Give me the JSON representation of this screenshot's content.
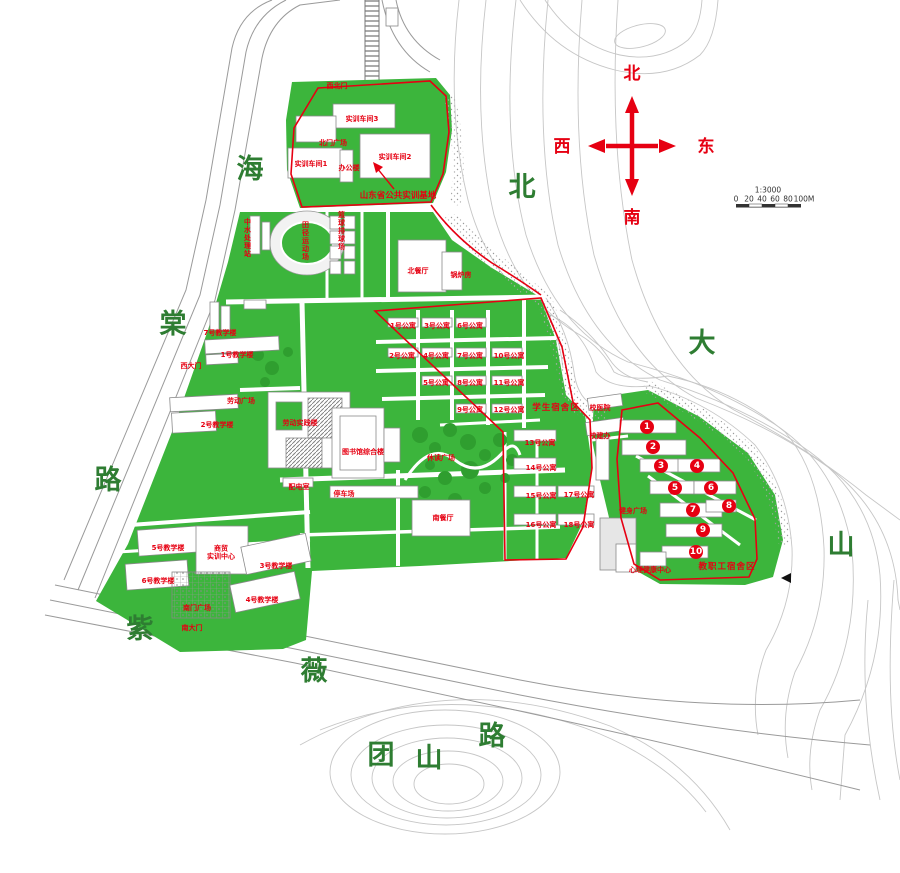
{
  "colors": {
    "campus_green": "#3cb53c",
    "label_red": "#e60012",
    "road_name_green": "#2e7d32",
    "contour_gray": "#c6c6c6"
  },
  "compass": {
    "north": "北",
    "south": "南",
    "east": "东",
    "west": "西"
  },
  "scale": {
    "ratio": "1:3000",
    "ticks": [
      "0",
      "20",
      "40",
      "60",
      "80",
      "100M"
    ]
  },
  "road_names": [
    {
      "name": "road-haitang-char-1",
      "text": "海",
      "x": 250,
      "y": 170
    },
    {
      "name": "road-haitang-char-2",
      "text": "棠",
      "x": 173,
      "y": 325
    },
    {
      "name": "road-haitang-char-3",
      "text": "路",
      "x": 108,
      "y": 481
    },
    {
      "name": "road-ziwei-char-1",
      "text": "紫",
      "x": 140,
      "y": 630
    },
    {
      "name": "road-ziwei-char-2",
      "text": "薇",
      "x": 314,
      "y": 672
    },
    {
      "name": "road-tuanshan-char-3",
      "text": "路",
      "x": 492,
      "y": 737
    },
    {
      "name": "road-tuanshan-char-1",
      "text": "团",
      "x": 381,
      "y": 756
    },
    {
      "name": "road-tuanshan-char-2",
      "text": "山",
      "x": 429,
      "y": 759
    },
    {
      "name": "mountain-beidashan-char-1",
      "text": "北",
      "x": 522,
      "y": 188
    },
    {
      "name": "mountain-beidashan-char-2",
      "text": "大",
      "x": 702,
      "y": 344
    },
    {
      "name": "mountain-beidashan-char-3",
      "text": "山",
      "x": 841,
      "y": 546
    }
  ],
  "labels": [
    {
      "name": "gate-northwest",
      "text": "西北门",
      "x": 337,
      "y": 86
    },
    {
      "name": "training-workshop-3",
      "text": "实训车间3",
      "x": 362,
      "y": 119
    },
    {
      "name": "north-gate-plaza",
      "text": "北门广场",
      "x": 333,
      "y": 143
    },
    {
      "name": "training-workshop-1",
      "text": "实训车间1",
      "x": 311,
      "y": 164
    },
    {
      "name": "office-building",
      "text": "办公楼",
      "x": 349,
      "y": 168
    },
    {
      "name": "training-workshop-2",
      "text": "实训车间2",
      "x": 395,
      "y": 157
    },
    {
      "name": "training-base-annotation",
      "text": "山东省公共实训基地",
      "x": 398,
      "y": 196,
      "cls": "note"
    },
    {
      "name": "water-treatment-station",
      "text": "中水处理站",
      "x": 247,
      "y": 238,
      "cls": "vert"
    },
    {
      "name": "athletics-field",
      "text": "田径运动场",
      "x": 305,
      "y": 241,
      "cls": "vert"
    },
    {
      "name": "basketball-volleyball-courts",
      "text": "篮球排球场",
      "x": 341,
      "y": 231,
      "cls": "vert"
    },
    {
      "name": "north-dining-hall",
      "text": "北餐厅",
      "x": 418,
      "y": 271
    },
    {
      "name": "boiler-room",
      "text": "锅炉房",
      "x": 461,
      "y": 275
    },
    {
      "name": "apartment-1",
      "text": "1号公寓",
      "x": 403,
      "y": 326
    },
    {
      "name": "apartment-3",
      "text": "3号公寓",
      "x": 437,
      "y": 326
    },
    {
      "name": "apartment-6",
      "text": "6号公寓",
      "x": 470,
      "y": 326
    },
    {
      "name": "apartment-2",
      "text": "2号公寓",
      "x": 402,
      "y": 356
    },
    {
      "name": "apartment-4",
      "text": "4号公寓",
      "x": 436,
      "y": 356
    },
    {
      "name": "apartment-7",
      "text": "7号公寓",
      "x": 470,
      "y": 356
    },
    {
      "name": "apartment-10",
      "text": "10号公寓",
      "x": 509,
      "y": 356
    },
    {
      "name": "apartment-5",
      "text": "5号公寓",
      "x": 436,
      "y": 383
    },
    {
      "name": "apartment-8",
      "text": "8号公寓",
      "x": 470,
      "y": 383
    },
    {
      "name": "apartment-11",
      "text": "11号公寓",
      "x": 509,
      "y": 383
    },
    {
      "name": "apartment-9",
      "text": "9号公寓",
      "x": 470,
      "y": 410
    },
    {
      "name": "apartment-12",
      "text": "12号公寓",
      "x": 509,
      "y": 410
    },
    {
      "name": "student-dorm-area",
      "text": "学生宿舍区",
      "x": 556,
      "y": 408,
      "cls": "big"
    },
    {
      "name": "apartment-13",
      "text": "13号公寓",
      "x": 540,
      "y": 443
    },
    {
      "name": "apartment-14",
      "text": "14号公寓",
      "x": 541,
      "y": 468
    },
    {
      "name": "apartment-15",
      "text": "15号公寓",
      "x": 541,
      "y": 496
    },
    {
      "name": "apartment-16",
      "text": "16号公寓",
      "x": 541,
      "y": 525
    },
    {
      "name": "apartment-17",
      "text": "17号公寓",
      "x": 579,
      "y": 495
    },
    {
      "name": "apartment-18",
      "text": "18号公寓",
      "x": 579,
      "y": 525
    },
    {
      "name": "campus-hospital",
      "text": "校医院",
      "x": 600,
      "y": 408
    },
    {
      "name": "campus-construction-office",
      "text": "校建办",
      "x": 600,
      "y": 436
    },
    {
      "name": "fitness-plaza",
      "text": "健身广场",
      "x": 633,
      "y": 511
    },
    {
      "name": "mental-health-center",
      "text": "心理健康中心",
      "x": 650,
      "y": 570
    },
    {
      "name": "faculty-dorm-area",
      "text": "教职工宿舍区",
      "x": 727,
      "y": 567,
      "cls": "big"
    },
    {
      "name": "teaching-building-7",
      "text": "7号教学楼",
      "x": 220,
      "y": 333
    },
    {
      "name": "west-gate",
      "text": "西大门",
      "x": 191,
      "y": 366
    },
    {
      "name": "labor-plaza",
      "text": "劳动广场",
      "x": 241,
      "y": 401
    },
    {
      "name": "teaching-building-1",
      "text": "1号教学楼",
      "x": 237,
      "y": 355
    },
    {
      "name": "teaching-building-2",
      "text": "2号教学楼",
      "x": 217,
      "y": 425
    },
    {
      "name": "labor-practice-building",
      "text": "劳动实践楼",
      "x": 300,
      "y": 423
    },
    {
      "name": "library-complex",
      "text": "图书馆综合楼",
      "x": 363,
      "y": 452
    },
    {
      "name": "leisure-reading-plaza",
      "text": "休读广场",
      "x": 441,
      "y": 458
    },
    {
      "name": "power-distribution-room",
      "text": "配电室",
      "x": 299,
      "y": 487
    },
    {
      "name": "parking-lot",
      "text": "停车场",
      "x": 344,
      "y": 494
    },
    {
      "name": "south-dining-hall",
      "text": "南餐厅",
      "x": 443,
      "y": 518
    },
    {
      "name": "teaching-building-5",
      "text": "5号教学楼",
      "x": 168,
      "y": 548
    },
    {
      "name": "business-training-center",
      "text": "商贸\n实训中心",
      "x": 221,
      "y": 553
    },
    {
      "name": "teaching-building-3",
      "text": "3号教学楼",
      "x": 276,
      "y": 566
    },
    {
      "name": "teaching-building-6",
      "text": "6号教学楼",
      "x": 158,
      "y": 581
    },
    {
      "name": "teaching-building-4",
      "text": "4号教学楼",
      "x": 262,
      "y": 600
    },
    {
      "name": "south-gate-plaza",
      "text": "南门广场",
      "x": 197,
      "y": 608
    },
    {
      "name": "south-gate",
      "text": "南大门",
      "x": 192,
      "y": 628
    }
  ],
  "faculty_markers": [
    {
      "n": "1",
      "x": 647,
      "y": 427
    },
    {
      "n": "2",
      "x": 653,
      "y": 447
    },
    {
      "n": "3",
      "x": 661,
      "y": 466
    },
    {
      "n": "4",
      "x": 697,
      "y": 466
    },
    {
      "n": "5",
      "x": 675,
      "y": 488
    },
    {
      "n": "6",
      "x": 711,
      "y": 488
    },
    {
      "n": "7",
      "x": 693,
      "y": 510
    },
    {
      "n": "8",
      "x": 729,
      "y": 506
    },
    {
      "n": "9",
      "x": 703,
      "y": 530
    },
    {
      "n": "10",
      "x": 696,
      "y": 552
    }
  ],
  "pointer_triangle": {
    "x": 786,
    "y": 578
  }
}
